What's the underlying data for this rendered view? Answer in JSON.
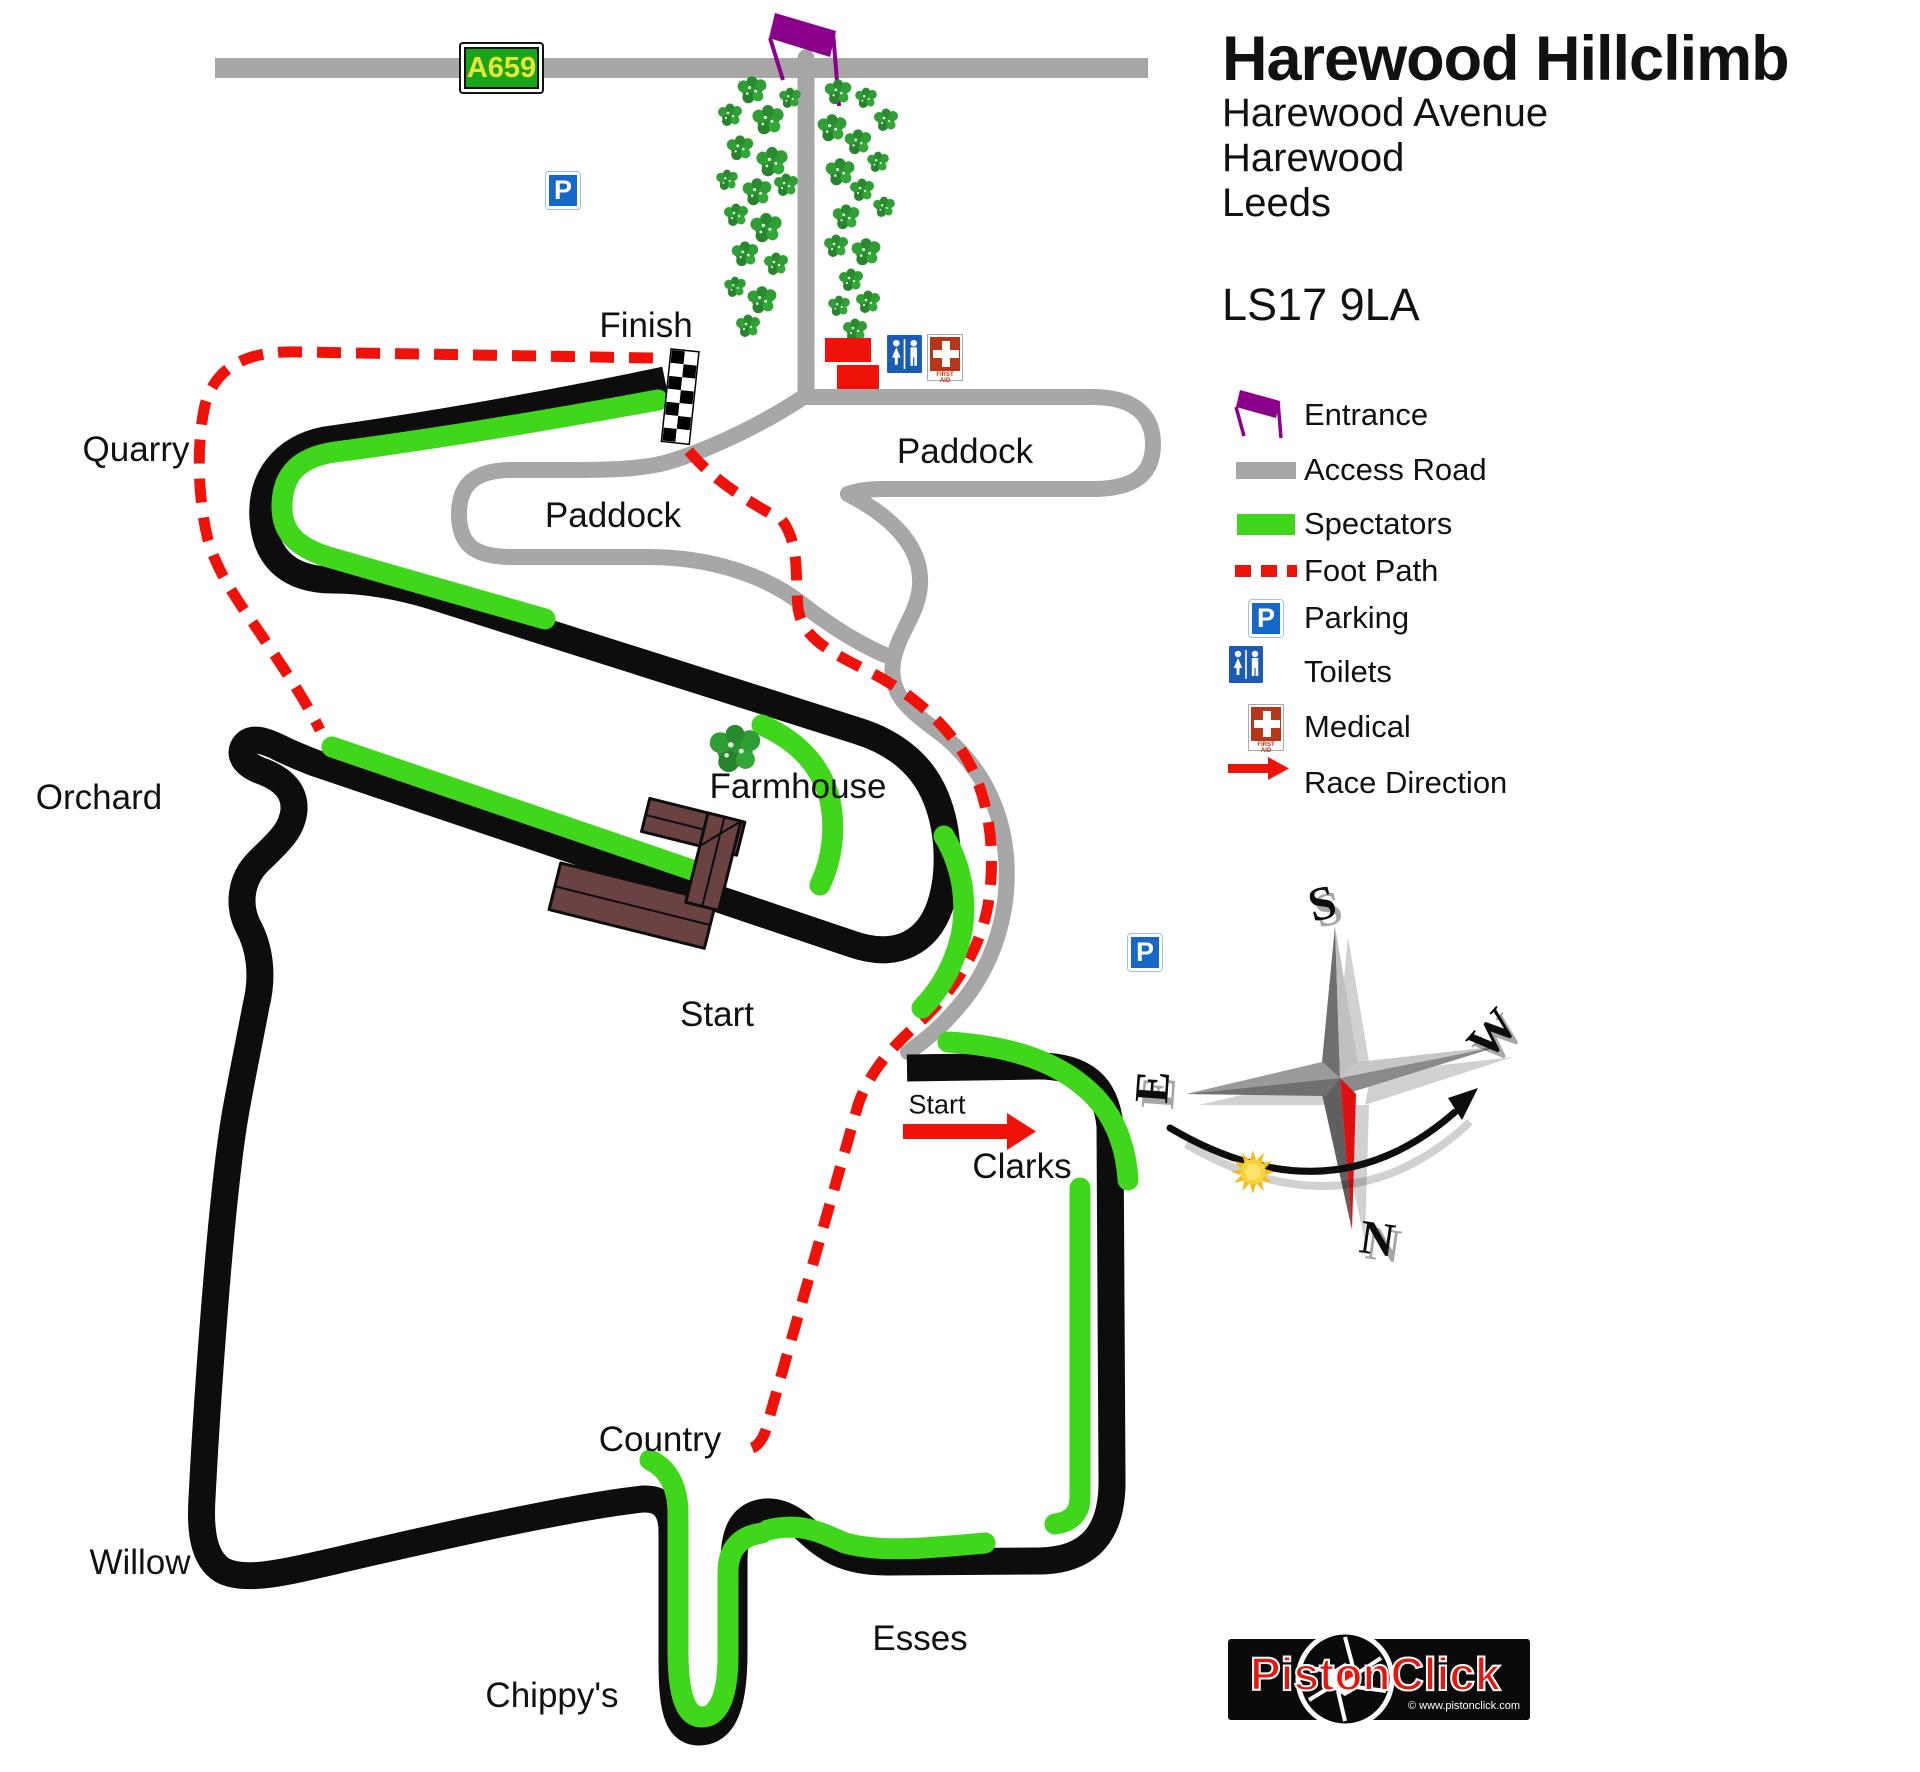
{
  "title": {
    "heading": "Harewood Hillclimb",
    "address_line1": "Harewood Avenue",
    "address_line2": "Harewood",
    "address_line3": "Leeds",
    "postcode": "LS17 9LA"
  },
  "legend": {
    "items": [
      {
        "icon": "entrance-flag-icon",
        "label": "Entrance"
      },
      {
        "icon": "access-road-icon",
        "label": "Access Road"
      },
      {
        "icon": "spectators-icon",
        "label": "Spectators"
      },
      {
        "icon": "foot-path-icon",
        "label": "Foot Path"
      },
      {
        "icon": "parking-icon",
        "label": "Parking"
      },
      {
        "icon": "toilets-icon",
        "label": "Toilets"
      },
      {
        "icon": "medical-icon",
        "label": "Medical"
      },
      {
        "icon": "race-direction-icon",
        "label": "Race Direction"
      }
    ]
  },
  "track_labels": {
    "finish": "Finish",
    "quarry": "Quarry",
    "orchard": "Orchard",
    "farmhouse": "Farmhouse",
    "paddock_left": "Paddock",
    "paddock_right": "Paddock",
    "start_main": "Start",
    "start_line": "Start",
    "clarks": "Clarks",
    "country": "Country",
    "willow": "Willow",
    "chippys": "Chippy's",
    "esses": "Esses"
  },
  "signs": {
    "road_number": "A659",
    "parking_letter": "P",
    "first_aid_line1": "FIRST",
    "first_aid_line2": "AID"
  },
  "compass": {
    "north": "N",
    "south": "S",
    "east": "E",
    "west": "W"
  },
  "logo": {
    "name": "PistonClick",
    "url_text": "© www.pistonclick.com"
  },
  "colors": {
    "track": "#0d0d0d",
    "spectators_green": "#3fd61c",
    "access_road_gray": "#a7a7a7",
    "foot_path_red": "#ee1209",
    "entrance_purple": "#8B008B",
    "building_brown": "#6b4242",
    "parking_blue": "#1668c8",
    "medical_red": "#b5361b",
    "logo_red": "#e8150c"
  }
}
